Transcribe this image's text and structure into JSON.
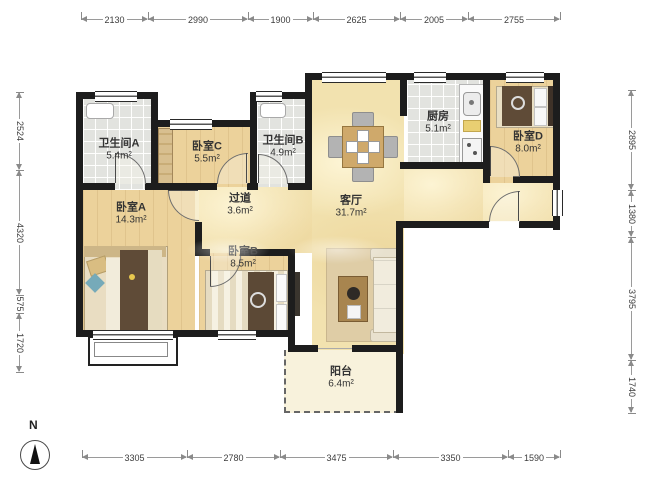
{
  "rooms": {
    "bath_a": {
      "name": "卫生间A",
      "area": "5.4m²"
    },
    "bed_c": {
      "name": "卧室C",
      "area": "5.5m²"
    },
    "bath_b": {
      "name": "卫生间B",
      "area": "4.9m²"
    },
    "kitchen": {
      "name": "厨房",
      "area": "5.1m²"
    },
    "bed_d": {
      "name": "卧室D",
      "area": "8.0m²"
    },
    "bed_a": {
      "name": "卧室A",
      "area": "14.3m²"
    },
    "hallway": {
      "name": "过道",
      "area": "3.6m²"
    },
    "living": {
      "name": "客厅",
      "area": "31.7m²"
    },
    "bed_b": {
      "name": "卧室B",
      "area": "8.5m²"
    },
    "balcony": {
      "name": "阳台",
      "area": "6.4m²"
    }
  },
  "compass": {
    "label": "N"
  },
  "dimensions": {
    "top": [
      "2130",
      "2990",
      "1900",
      "2625",
      "2005",
      "2755"
    ],
    "bottom": [
      "3305",
      "2780",
      "3475",
      "3350",
      "1590"
    ],
    "left": [
      "2524",
      "4320",
      "575",
      "1720"
    ],
    "right": [
      "2895",
      "1380",
      "3795",
      "1740"
    ]
  },
  "colors": {
    "wall": "#1d1d1d",
    "wood_floor": "#ecd29b",
    "living_floor": "#f2e2af",
    "tile_floor": "#e2e3df",
    "balcony_floor": "#f8f2dc",
    "furniture_brown": "#5f4b37",
    "pillow_teal": "#76aab9"
  }
}
